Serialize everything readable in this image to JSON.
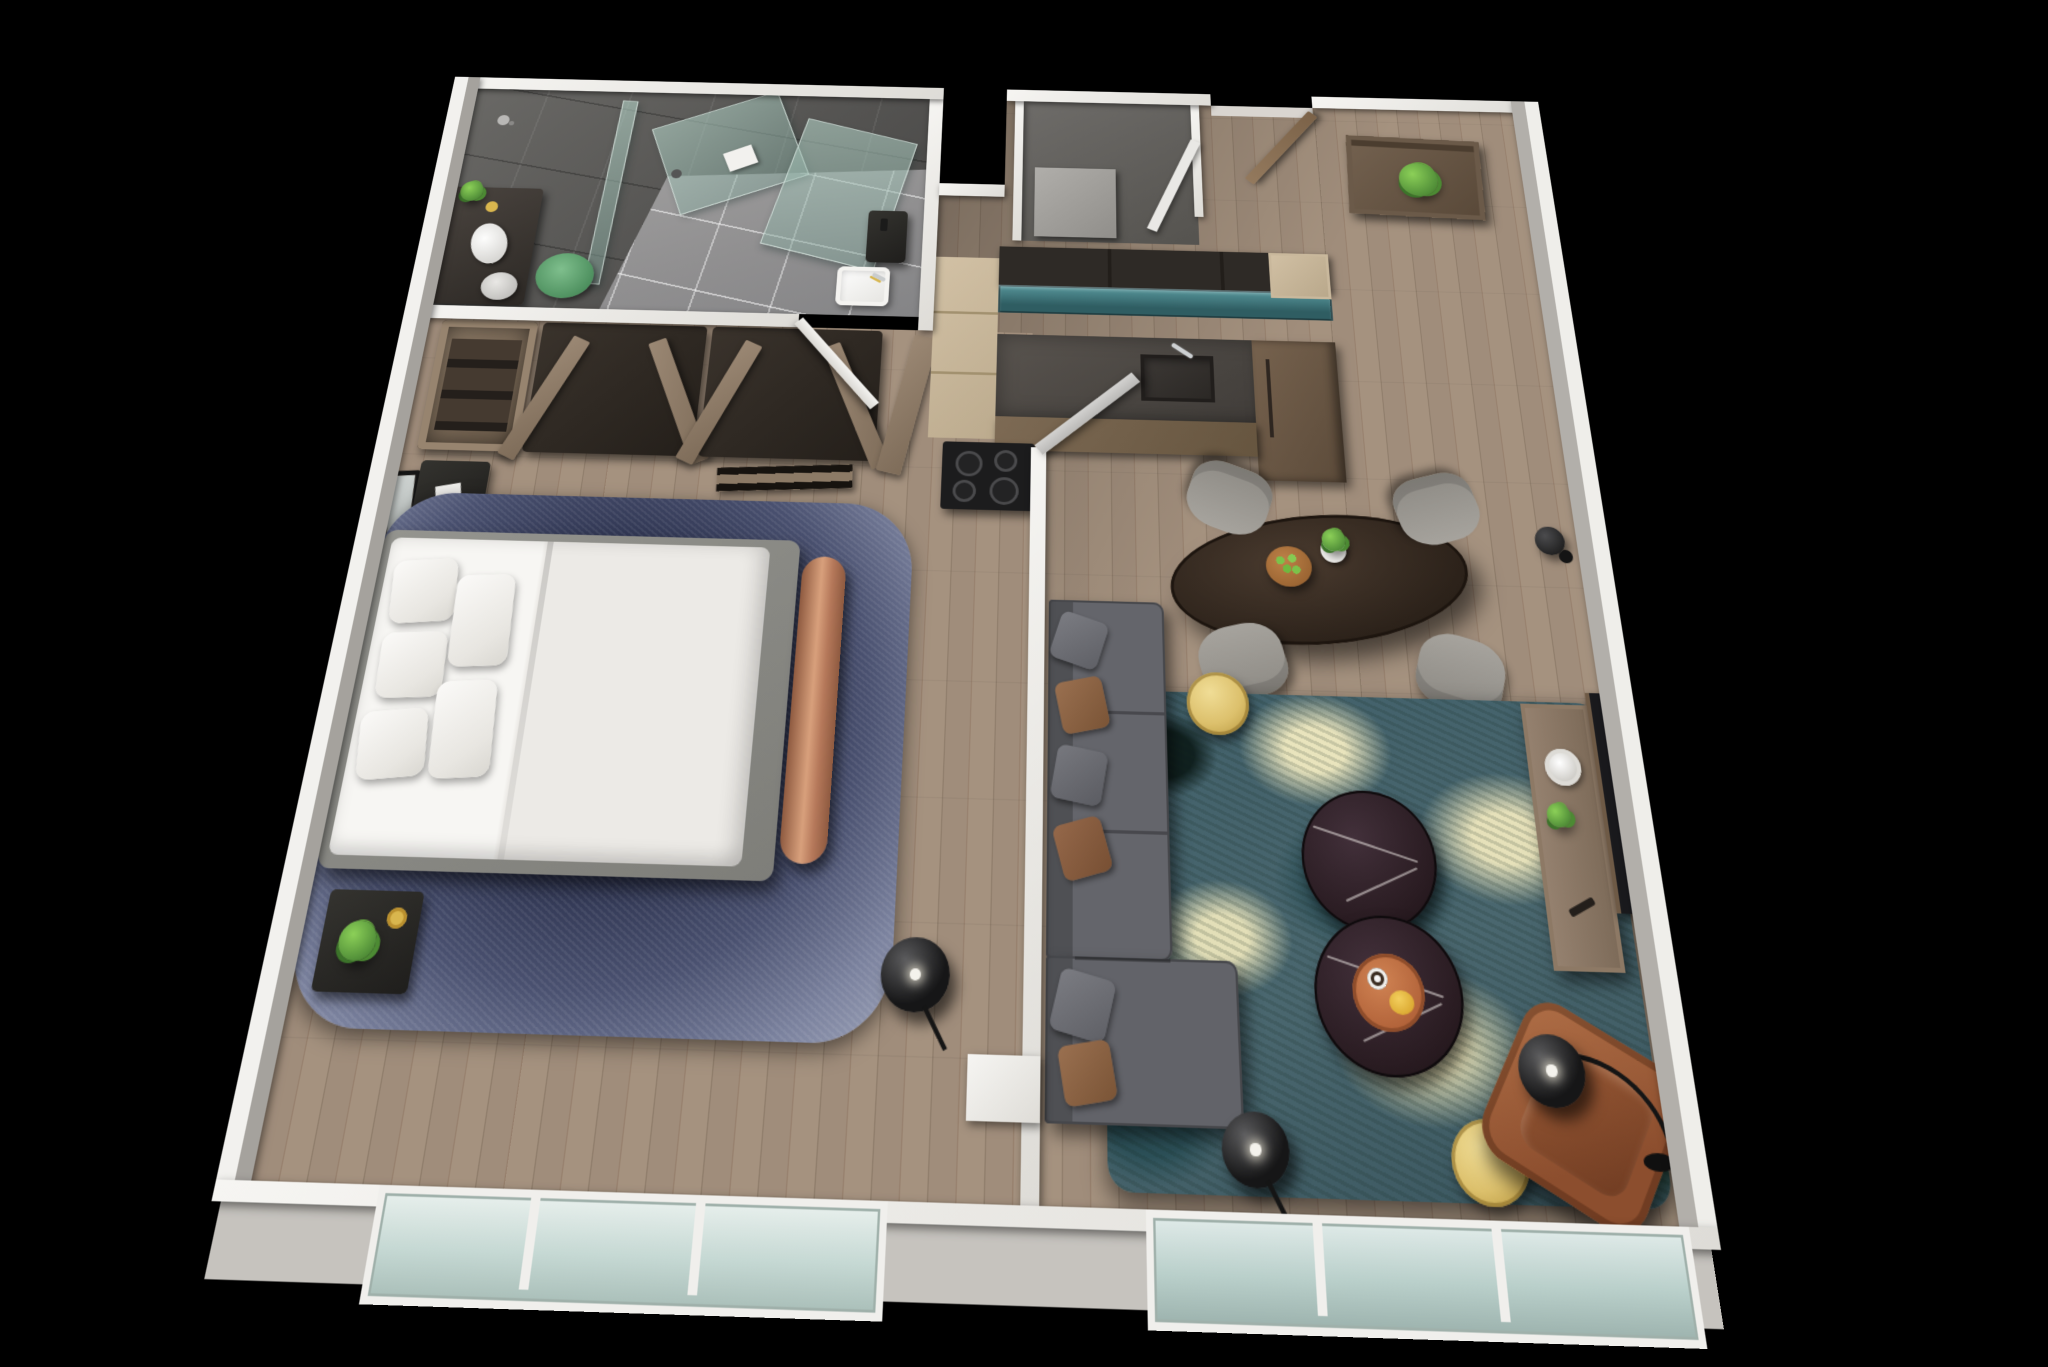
{
  "scene": {
    "type": "3d-floor-plan-rendering",
    "view": "top-down isometric dollhouse",
    "background_color": "#000000",
    "unit": "one-bedroom apartment suite",
    "visible_text": "none"
  },
  "palette": {
    "wall_white": "#efeeea",
    "wall_outer_face": "#c6c3be",
    "wood_floor": "#9c8a78",
    "bath_floor_tile": "#9d9c9d",
    "bath_wall_tile": "#565554",
    "shower_glass": "#9db8ac",
    "bedroom_rug": "#2e3450",
    "living_rug_teal": "#41606a",
    "living_rug_cream": "#e9e4bd",
    "sofa_gray": "#616267",
    "pillow_brown": "#8a6243",
    "bed_white": "#f1efec",
    "bench_copper": "#c08b6c",
    "nightstand_black": "#262524",
    "gold_accent": "#dcc06c",
    "marble_table": "#2a1c22",
    "leather_chair": "#9c5a38",
    "dining_table_wood": "#30251d",
    "chair_gray": "#9a978f",
    "kitchen_cabinet_dark": "#2e2a26",
    "kitchen_glass_teal": "#3e6f74",
    "kitchen_counter": "#4e4a46",
    "kitchen_cabinet_tan": "#c9b89c",
    "door_wood": "#8a7258",
    "plant_green": "#5f9c46",
    "window_glass": "#cfe0dc"
  },
  "rooms": [
    {
      "name": "bathroom",
      "position": "top-left",
      "features": [
        "dark-tile-walls",
        "light-tile-floor",
        "walk-in-shower"
      ],
      "furniture": [
        "glass-shower-panels",
        "shower-towel",
        "vanity-counter",
        "vanity-plant",
        "round-mirror-tray",
        "white-stool",
        "green-stool",
        "white-sink-basin",
        "bathroom-door-white"
      ]
    },
    {
      "name": "bedroom",
      "position": "left",
      "features": [
        "wood-floor",
        "mottled-navy-rug",
        "window-wall-bottom"
      ],
      "furniture": [
        "open-wardrobe-units",
        "wardrobe-v-doors",
        "wall-mirror",
        "nightstand-head",
        "nightstand-foot",
        "nightstand-plant",
        "double-bed",
        "bed-pillows-x4",
        "white-duvet",
        "copper-bench",
        "black-floor-lamp",
        "bedroom-door-gray"
      ]
    },
    {
      "name": "kitchen",
      "position": "top-center",
      "features": [
        "galley-layout",
        "wood-floor"
      ],
      "furniture": [
        "dark-upper-cabinets",
        "teal-glass-cabinet-band",
        "stone-counter",
        "kitchen-sink",
        "faucet",
        "tall-tan-cabinet-column",
        "tan-corner-cabinet",
        "tall-fridge-panel",
        "cooktop-4-burners"
      ]
    },
    {
      "name": "entry-hall",
      "position": "top-right",
      "features": [
        "wood-floor",
        "exterior-notch"
      ],
      "furniture": [
        "utility-alcove",
        "entry-door-wood-open",
        "entry-console",
        "console-plant"
      ]
    },
    {
      "name": "dining-area",
      "position": "center-right",
      "furniture": [
        "oval-dining-table",
        "dining-chairs-x4",
        "fruit-bowl-green-apples",
        "succulent-pot",
        "wall-sconce-black"
      ]
    },
    {
      "name": "living-room",
      "position": "bottom-right",
      "features": [
        "teal-abstract-rug",
        "window-wall-bottom"
      ],
      "furniture": [
        "gray-sectional-sofa",
        "sofa-pillows",
        "gold-side-table-small",
        "gold-side-table-large",
        "marble-coffee-table-x2",
        "orange-tray",
        "coffee-cup",
        "leather-armchair",
        "arc-floor-lamp",
        "black-floor-lamp",
        "tv-console",
        "vase-white",
        "succulent",
        "remote-control",
        "wall-mounted-tv"
      ]
    }
  ],
  "counts": {
    "bed_pillows": 4,
    "dining_chairs": 4,
    "coffee_tables": 2,
    "gold_side_tables": 2,
    "floor_lamps": 3,
    "windows_bottom_wall": 2,
    "cooktop_burners": 4,
    "nightstands": 2
  }
}
